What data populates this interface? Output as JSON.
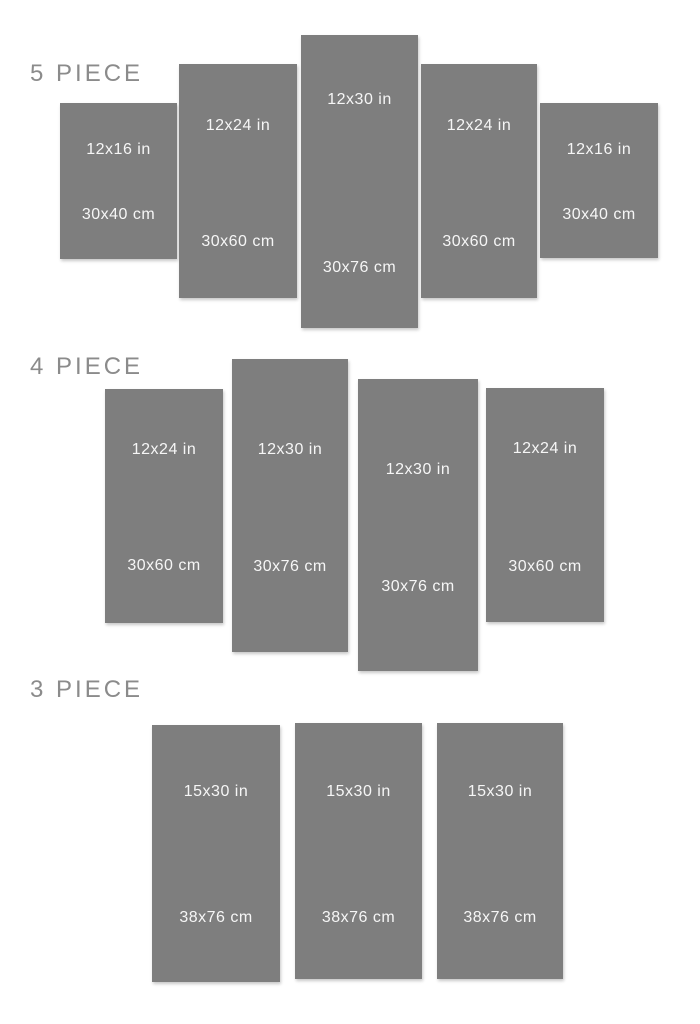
{
  "title": "Canvas set size chart",
  "colors": {
    "background": "#ffffff",
    "panel": "#7e7e7e",
    "panel_text": "#f6f6f6",
    "section_label": "#8b8b8b"
  },
  "sections": [
    {
      "label": "5 PIECE",
      "panels": [
        {
          "inches": "12x16 in",
          "cm": "30x40 cm"
        },
        {
          "inches": "12x24 in",
          "cm": "30x60 cm"
        },
        {
          "inches": "12x30 in",
          "cm": "30x76 cm"
        },
        {
          "inches": "12x24 in",
          "cm": "30x60 cm"
        },
        {
          "inches": "12x16 in",
          "cm": "30x40 cm"
        }
      ]
    },
    {
      "label": "4 PIECE",
      "panels": [
        {
          "inches": "12x24 in",
          "cm": "30x60 cm"
        },
        {
          "inches": "12x30 in",
          "cm": "30x76 cm"
        },
        {
          "inches": "12x30 in",
          "cm": "30x76 cm"
        },
        {
          "inches": "12x24 in",
          "cm": "30x60 cm"
        }
      ]
    },
    {
      "label": "3 PIECE",
      "panels": [
        {
          "inches": "15x30 in",
          "cm": "38x76 cm"
        },
        {
          "inches": "15x30 in",
          "cm": "38x76 cm"
        },
        {
          "inches": "15x30 in",
          "cm": "38x76 cm"
        }
      ]
    }
  ]
}
